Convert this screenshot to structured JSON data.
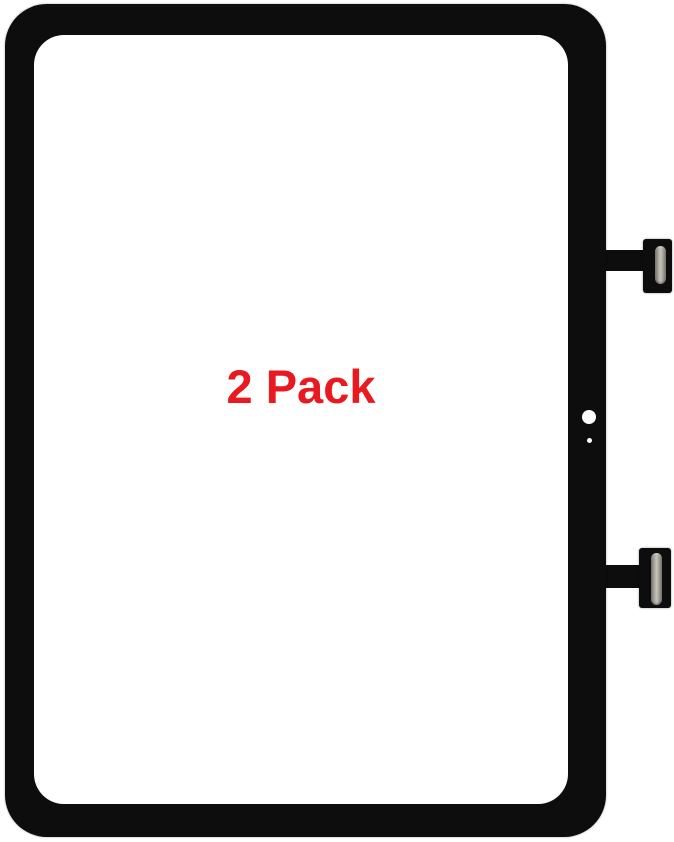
{
  "image": {
    "background_color": "#ffffff",
    "label": {
      "text": "2 Pack",
      "color": "#e8191f"
    },
    "device": {
      "part": "tablet touch screen digitizer front glass",
      "frame_color": "#0d0d0d",
      "screen_color": "#ffffff",
      "features": {
        "camera_hole": "white circle in right bezel",
        "microphone_hole": "small white dot below camera hole"
      },
      "connectors": [
        {
          "position": "top-right",
          "type": "flex-cable-connector",
          "slot_color": "#a8a59d"
        },
        {
          "position": "bottom-right",
          "type": "flex-cable-connector",
          "slot_color": "#a8a59d"
        }
      ]
    }
  }
}
